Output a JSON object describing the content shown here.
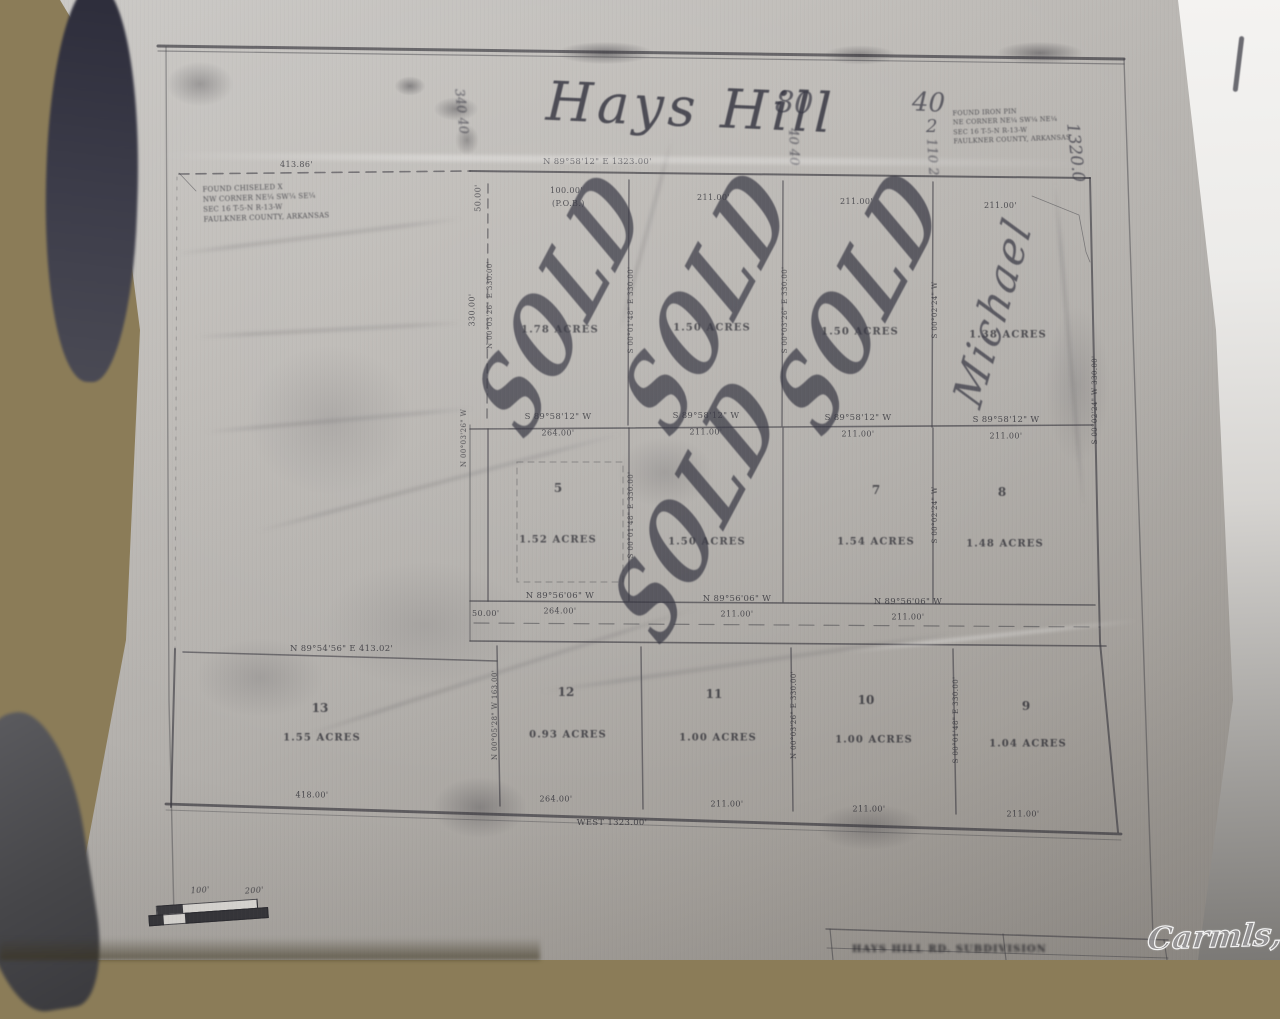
{
  "photo": {
    "watermark": "Carmls, Inc"
  },
  "plat": {
    "title": "Hays Hill",
    "handwritten": {
      "sold": "SOLD",
      "buyer_name": "Michael",
      "note_80": "80",
      "note_40": "40",
      "note_2": "2",
      "tally_left": "340 40",
      "tally_80": "40 40",
      "tally_40": "110 2",
      "east_dim": "1320.0"
    },
    "corner_note_nw": [
      "FOUND CHISELED X",
      "NW CORNER NE¼ SW¼ SE¼",
      "SEC 16  T-5-N  R-13-W",
      "FAULKNER COUNTY, ARKANSAS"
    ],
    "corner_note_ne": [
      "FOUND IRON PIN",
      "NE CORNER NE¼ SW¼ NE¼",
      "SEC 16  T-5-N  R-13-W",
      "FAULKNER COUNTY, ARKANSAS"
    ],
    "north_line": {
      "bearing": "N 89°58'12\" E   1323.00'",
      "west_dim": "413.86'"
    },
    "south_line": {
      "bearing": "WEST   1323.00'",
      "dims": [
        "418.00'",
        "264.00'",
        "211.00'",
        "211.00'",
        "211.00'"
      ]
    },
    "lot13_line": "N 89°54'56\" E   413.02'",
    "row1_dims": {
      "west_offset": "50.00'",
      "d1": "100.00'",
      "pob": "(P.O.B.)",
      "d2": "211.00'",
      "d3": "211.00'",
      "d4": "211.00'"
    },
    "row2_line": {
      "bearing": "S 89°58'12\" W",
      "dims": [
        "264.00'",
        "211.00'",
        "211.00'",
        "211.00'"
      ]
    },
    "road": {
      "bearing": "N 89°56'06\" W",
      "dims": [
        "264.00'",
        "211.00'",
        "211.00'"
      ],
      "west_offset": "50.00'"
    },
    "side_labels": {
      "west_top": "330.00'",
      "west_bearing": "N 00°03'26\" W",
      "col1": "N 00°03'26\" E  330.00'",
      "col2": "S 00°01'48\" E  330.00'",
      "col3": "S 00°03'26\" E  330.00'",
      "col4": "S 00°02'24\" W",
      "east": "S 00°02'24\" W  330.00'",
      "lot13_east": "N 00°05'28\" W  163.00'"
    },
    "lots": [
      {
        "number": "",
        "acres": "1.78 ACRES"
      },
      {
        "number": "",
        "acres": "1.50 ACRES"
      },
      {
        "number": "",
        "acres": "1.50 ACRES"
      },
      {
        "number": "",
        "acres": "1.38 ACRES"
      },
      {
        "number": "5",
        "acres": "1.52 ACRES"
      },
      {
        "number": "",
        "acres": "1.50 ACRES"
      },
      {
        "number": "7",
        "acres": "1.54 ACRES"
      },
      {
        "number": "8",
        "acres": "1.48 ACRES"
      },
      {
        "number": "13",
        "acres": "1.55 ACRES"
      },
      {
        "number": "12",
        "acres": "0.93 ACRES"
      },
      {
        "number": "11",
        "acres": "1.00 ACRES"
      },
      {
        "number": "10",
        "acres": "1.00 ACRES"
      },
      {
        "number": "9",
        "acres": "1.04 ACRES"
      }
    ],
    "scale_bar": {
      "left": "100'",
      "right": "200'"
    },
    "title_block": "HAYS HILL RD.  SUBDIVISION"
  }
}
